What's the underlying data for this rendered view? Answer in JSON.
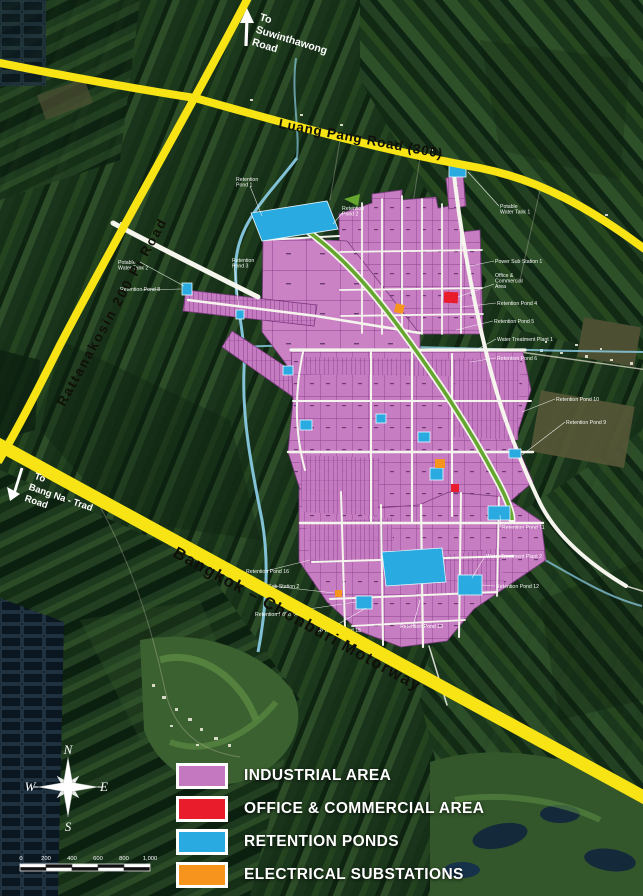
{
  "map": {
    "roads": {
      "luang_pang": "Luang Pang Road (300)",
      "rattanakosin": "Rattanakosin 200 Pi Road",
      "motorway": "Bangkok – Chonburi Motorway",
      "to_suwinthawong": [
        "To",
        "Suwinthawong",
        "Road"
      ],
      "to_bangna": [
        "To",
        "Bang Na - Trad",
        "Road"
      ]
    },
    "compass": {
      "n": "N",
      "e": "E",
      "s": "S",
      "w": "W"
    },
    "scale": {
      "ticks": [
        "0",
        "200",
        "400",
        "600",
        "800",
        "1,000"
      ]
    },
    "small_labels": [
      {
        "x": 236,
        "y": 181,
        "lines": [
          "Retention",
          "Pond 1"
        ]
      },
      {
        "x": 342,
        "y": 210,
        "lines": [
          "Retention",
          "Pond 2"
        ]
      },
      {
        "x": 232,
        "y": 262,
        "lines": [
          "Retention",
          "Pond 3"
        ]
      },
      {
        "x": 118,
        "y": 264,
        "lines": [
          "Potable",
          "Water Tank 2"
        ]
      },
      {
        "x": 120,
        "y": 291,
        "lines": [
          "Retention Pond 8"
        ]
      },
      {
        "x": 500,
        "y": 208,
        "lines": [
          "Potable",
          "Water Tank 1"
        ]
      },
      {
        "x": 495,
        "y": 263,
        "lines": [
          "Power Sub Station 1"
        ]
      },
      {
        "x": 495,
        "y": 277,
        "lines": [
          "Office &",
          "Commercial",
          "Area"
        ]
      },
      {
        "x": 497,
        "y": 305,
        "lines": [
          "Retention Pond 4"
        ]
      },
      {
        "x": 494,
        "y": 323,
        "lines": [
          "Retention Pond 5"
        ]
      },
      {
        "x": 497,
        "y": 341,
        "lines": [
          "Water Treatment Plant 1"
        ]
      },
      {
        "x": 497,
        "y": 360,
        "lines": [
          "Retention Pond 6"
        ]
      },
      {
        "x": 556,
        "y": 401,
        "lines": [
          "Retention Pond 10"
        ]
      },
      {
        "x": 566,
        "y": 424,
        "lines": [
          "Retention Pond 9"
        ]
      },
      {
        "x": 502,
        "y": 529,
        "lines": [
          "Retention Pond 11"
        ]
      },
      {
        "x": 486,
        "y": 558,
        "lines": [
          "Water Treatment Plant 2"
        ]
      },
      {
        "x": 496,
        "y": 588,
        "lines": [
          "Retention Pond 12"
        ]
      },
      {
        "x": 246,
        "y": 573,
        "lines": [
          "Retention Pond 16"
        ]
      },
      {
        "x": 252,
        "y": 588,
        "lines": [
          "Power Sub Station 2"
        ]
      },
      {
        "x": 255,
        "y": 616,
        "lines": [
          "Retention Pond 14"
        ]
      },
      {
        "x": 318,
        "y": 632,
        "lines": [
          "Retention Pond 15"
        ]
      },
      {
        "x": 400,
        "y": 628,
        "lines": [
          "Retention Pond 13"
        ]
      }
    ]
  },
  "legend": {
    "items": [
      {
        "label": "INDUSTRIAL AREA",
        "color": "#c478c0"
      },
      {
        "label": "OFFICE & COMMERCIAL AREA",
        "color": "#e81c2a"
      },
      {
        "label": "RETENTION PONDS",
        "color": "#29abe2"
      },
      {
        "label": "ELECTRICAL SUBSTATIONS",
        "color": "#f7941d"
      }
    ]
  },
  "colors": {
    "highway_yellow": "#f8e414",
    "industrial_pink": "#c77dc2",
    "pond_blue": "#29abe2",
    "substation_orange": "#f7941d",
    "office_red": "#e81c2a",
    "green_strip": "#64a62e",
    "canal_blue": "#8ed2ec"
  }
}
